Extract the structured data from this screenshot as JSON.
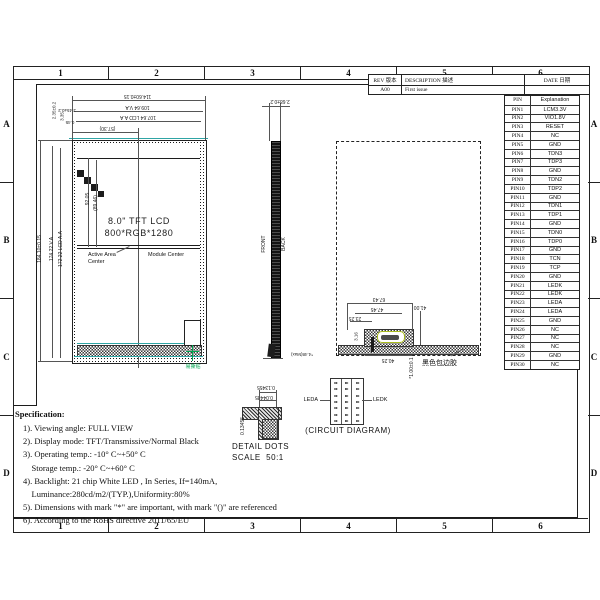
{
  "sheet": {
    "zones_h": [
      "1",
      "2",
      "3",
      "4",
      "5",
      "6"
    ],
    "zones_v": [
      "A",
      "B",
      "C",
      "D"
    ]
  },
  "revision_table": {
    "rev_header": "REV 版本",
    "description_header": "DESCRIPTION 描述",
    "date_header": "DATE 日期",
    "rows": [
      {
        "rev": "A00",
        "description": "First issue",
        "date": ""
      }
    ]
  },
  "pin_table": {
    "pin_header": "PIN",
    "explanation_header": "Explanation",
    "rows": [
      {
        "pin": "PIN1",
        "exp": "LCM3.3V"
      },
      {
        "pin": "PIN2",
        "exp": "VIO1.8V"
      },
      {
        "pin": "PIN3",
        "exp": "RESET"
      },
      {
        "pin": "PIN4",
        "exp": "NC"
      },
      {
        "pin": "PIN5",
        "exp": "GND"
      },
      {
        "pin": "PIN6",
        "exp": "TDN3"
      },
      {
        "pin": "PIN7",
        "exp": "TDP3"
      },
      {
        "pin": "PIN8",
        "exp": "GND"
      },
      {
        "pin": "PIN9",
        "exp": "TDN2"
      },
      {
        "pin": "PIN10",
        "exp": "TDP2"
      },
      {
        "pin": "PIN11",
        "exp": "GND"
      },
      {
        "pin": "PIN12",
        "exp": "TDN1"
      },
      {
        "pin": "PIN13",
        "exp": "TDP1"
      },
      {
        "pin": "PIN14",
        "exp": "GND"
      },
      {
        "pin": "PIN15",
        "exp": "TDN0"
      },
      {
        "pin": "PIN16",
        "exp": "TDP0"
      },
      {
        "pin": "PIN17",
        "exp": "GND"
      },
      {
        "pin": "PIN18",
        "exp": "TCN"
      },
      {
        "pin": "PIN19",
        "exp": "TCP"
      },
      {
        "pin": "PIN20",
        "exp": "GND"
      },
      {
        "pin": "PIN21",
        "exp": "LEDK"
      },
      {
        "pin": "PIN22",
        "exp": "LEDK"
      },
      {
        "pin": "PIN23",
        "exp": "LEDA"
      },
      {
        "pin": "PIN24",
        "exp": "LEDA"
      },
      {
        "pin": "PIN25",
        "exp": "GND"
      },
      {
        "pin": "PIN26",
        "exp": "NC"
      },
      {
        "pin": "PIN27",
        "exp": "NC"
      },
      {
        "pin": "PIN28",
        "exp": "NC"
      },
      {
        "pin": "PIN29",
        "exp": "GND"
      },
      {
        "pin": "PIN30",
        "exp": "NC"
      }
    ]
  },
  "front_view": {
    "title_line1": "8.0\" TFT LCD",
    "title_line2": "800*RGB*1280",
    "label_active_area_1": "Active Area",
    "label_active_area_2": "Center",
    "label_module_center": "Module Center",
    "label_tear_sticker": "易撕贴",
    "dim_total_width": "114.60±0.15",
    "dim_va_width": "109.64 V.A",
    "dim_aa_width": "107.64 LCD A.A",
    "dim_half_width": "(57.30)",
    "dim_offset_x1": "2.45±0.2",
    "dim_offset_x2": "0.45",
    "dim_offset_y1": "2.35±0.2",
    "dim_offset_y2": "3.35",
    "dim_total_height": "184.10±0.15",
    "dim_va_height": "174.22 V.A",
    "dim_aa_height": "172.22 LCD A.A",
    "dim_center_y": "92.05",
    "dim_center_y_ref": "(89.46)"
  },
  "side_view": {
    "dim_thickness": "2.68±0.2",
    "label_front": "FRONT",
    "label_back": "BACK",
    "dim_max_thickness": "*4.48(Max)"
  },
  "back_view": {
    "dim_fpc_total": "67.43",
    "dim_fpc_mid": "47.45",
    "dim_offset_left": "23.25",
    "dim_small_left": "3.16",
    "dim_right": "41.00",
    "dim_bottom": "40.25",
    "dim_thickness": "*1.00±0.1",
    "label_adhesive": "黑色包边胶"
  },
  "detail_dots": {
    "caption_line1": "DETAIL DOTS",
    "caption_line2": "SCALE  50:1",
    "dim_h1": "0.13455",
    "dim_h2": "0.04485",
    "dim_v": "0.13455"
  },
  "circuit_diagram": {
    "label_left": "LEDA",
    "label_right": "LEDK",
    "caption": "(CIRCUIT DIAGRAM)",
    "grid": {
      "rows": 7,
      "cols": 3
    },
    "diode_glyph": "▸▸"
  },
  "specification": {
    "title": "Specification:",
    "lines": [
      "1). Viewing angle: FULL VIEW",
      "2). Display mode: TFT/Transmissive/Normal Black",
      "3). Operating temp.: -10° C~+50° C",
      "    Storage temp.: -20° C~+60° C",
      "4). Backlight: 21 chip White LED , In Series, If=140mA,",
      "    Luminance:280cd/m2/(TYP.),Uniformity:80%",
      "5). Dimensions with mark \"*\" are important, with mark \"()\" are referenced",
      "6). According to the RoHS directive 2011/65/EU"
    ]
  },
  "colors": {
    "line": "#1c1c1c",
    "teal": "#2fa5a5",
    "green": "#00a651",
    "connector": "#a9bc1e"
  }
}
